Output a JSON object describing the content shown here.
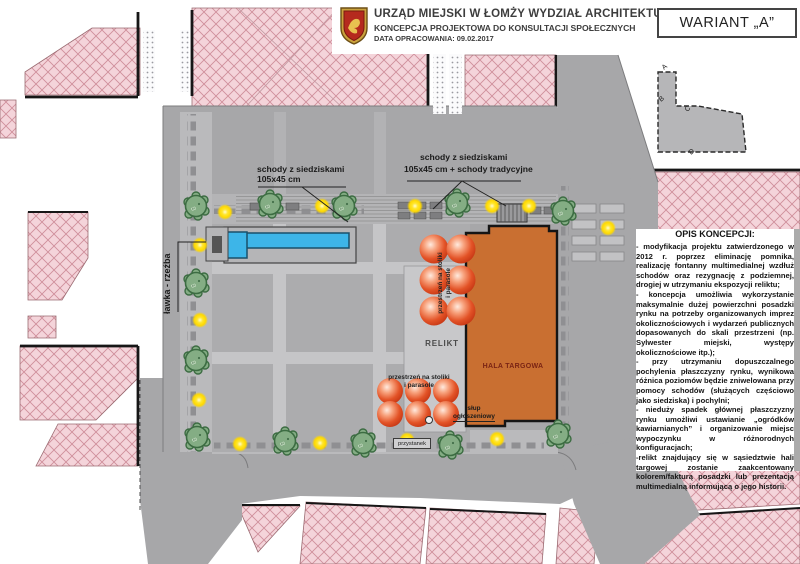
{
  "header": {
    "crest_icon": "lomza-coat-of-arms",
    "title": "URZĄD MIEJSKI W ŁOMŻY WYDZIAŁ ARCHITEKTURY",
    "subtitle": "KONCEPCJA PROJEKTOWA DO KONSULTACJI SPOŁECZNYCH",
    "date": "DATA OPRACOWANIA: 09.02.2017",
    "variant": "WARIANT „A”"
  },
  "description": {
    "title": "OPIS KONCEPCJI:",
    "paragraphs": [
      "- modyfikacja projektu zatwierdzonego w 2012 r. poprzez eliminację pomnika, realizację fontanny multimedialnej wzdłuż schodów oraz rezygnację z podziemnej, drogiej w utrzymaniu ekspozycji reliktu;",
      "- koncepcja umożliwia wykorzystanie maksymalnie dużej powierzchni posadzki rynku na potrzeby organizowanych imprez okolicznościowych i wydarzeń publicznych dopasowanych do skali przestrzeni (np. Sylwester miejski, występy okolicznościowe itp.);",
      "- przy utrzymaniu dopuszczalnego pochylenia płaszczyzny rynku, wynikowa różnica poziomów będzie zniwelowana przy pomocy schodów (służących częściowo jako siedziska) i pochylni;",
      "- nieduży spadek głównej płaszczyzny rynku umożliwi ustawianie „ogródków kawiarnianych” i organizowanie miejsc wypoczynku w różnorodnych konfiguracjach;",
      "-relikt znajdujący się w sąsiedztwie hali targowej zostanie zaakcentowany kolorem/fakturą posadzki lub prezentacją multimedialną informującą o jego historii."
    ]
  },
  "map_labels": {
    "stairs_left_line1": "schody z siedziskami",
    "stairs_left_line2": "105x45 cm",
    "stairs_right_line1": "schody z siedziskami",
    "stairs_right_line2": "105x45 cm + schody tradycyjne",
    "bench_sculpture": "ławka - rzeźba",
    "relic": "RELIKT",
    "market_hall": "HALA TARGOWA",
    "tables_upper_line1": "przestrzeń na stoliki",
    "tables_upper_line2": "i parasole",
    "tables_lower_line1": "przestrzeń na stoliki",
    "tables_lower_line2": "i parasole",
    "advert_column_line1": "słup",
    "advert_column_line2": "ogłoszeniowy",
    "bus_stop": "przystanek",
    "tree_mark": "50",
    "section_letters": {
      "a": "A",
      "b": "B",
      "c": "C",
      "d": "D",
      "h": "H"
    }
  },
  "legend_colors": {
    "market_hall": "#c96f31",
    "fountain": "#3db5e8",
    "tree": "#84ad84",
    "lamp": "#ffd900",
    "umbrella": "#e35327",
    "block_hatch": "#f4d4da",
    "plaza": "#a7a7a9"
  }
}
